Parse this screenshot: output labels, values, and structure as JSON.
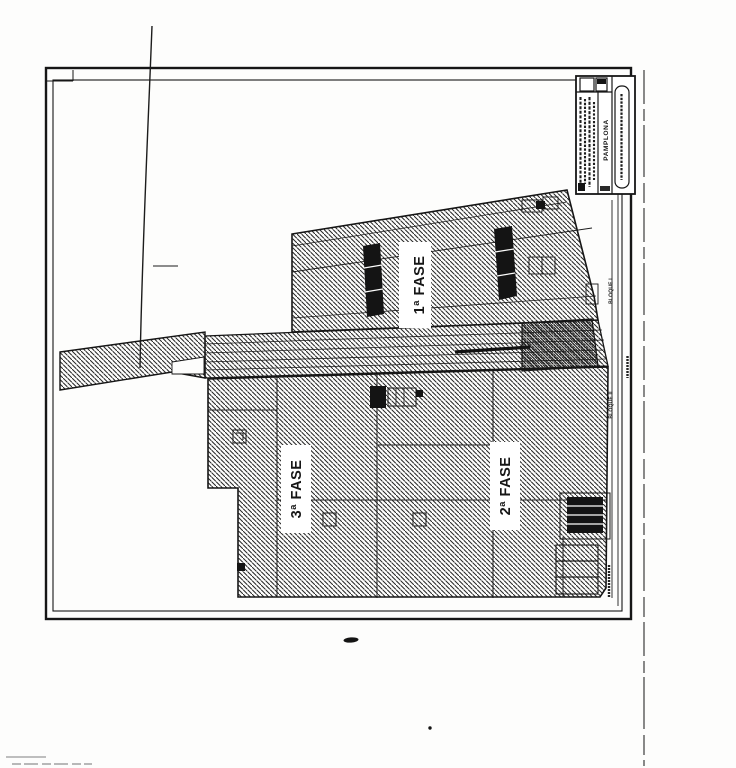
{
  "document": {
    "type": "scanned-site-plan",
    "ink_color": "#1a1a1a",
    "paper_color": "#fdfdfc"
  },
  "plan": {
    "phase_labels": [
      {
        "label": "1ª FASE"
      },
      {
        "label": "2ª FASE"
      },
      {
        "label": "3ª FASE"
      }
    ],
    "block_labels": [
      {
        "label": "BLOQUE I"
      },
      {
        "label": "BLOQUE II"
      }
    ],
    "title_block": {
      "city": "PAMPLONA"
    }
  }
}
